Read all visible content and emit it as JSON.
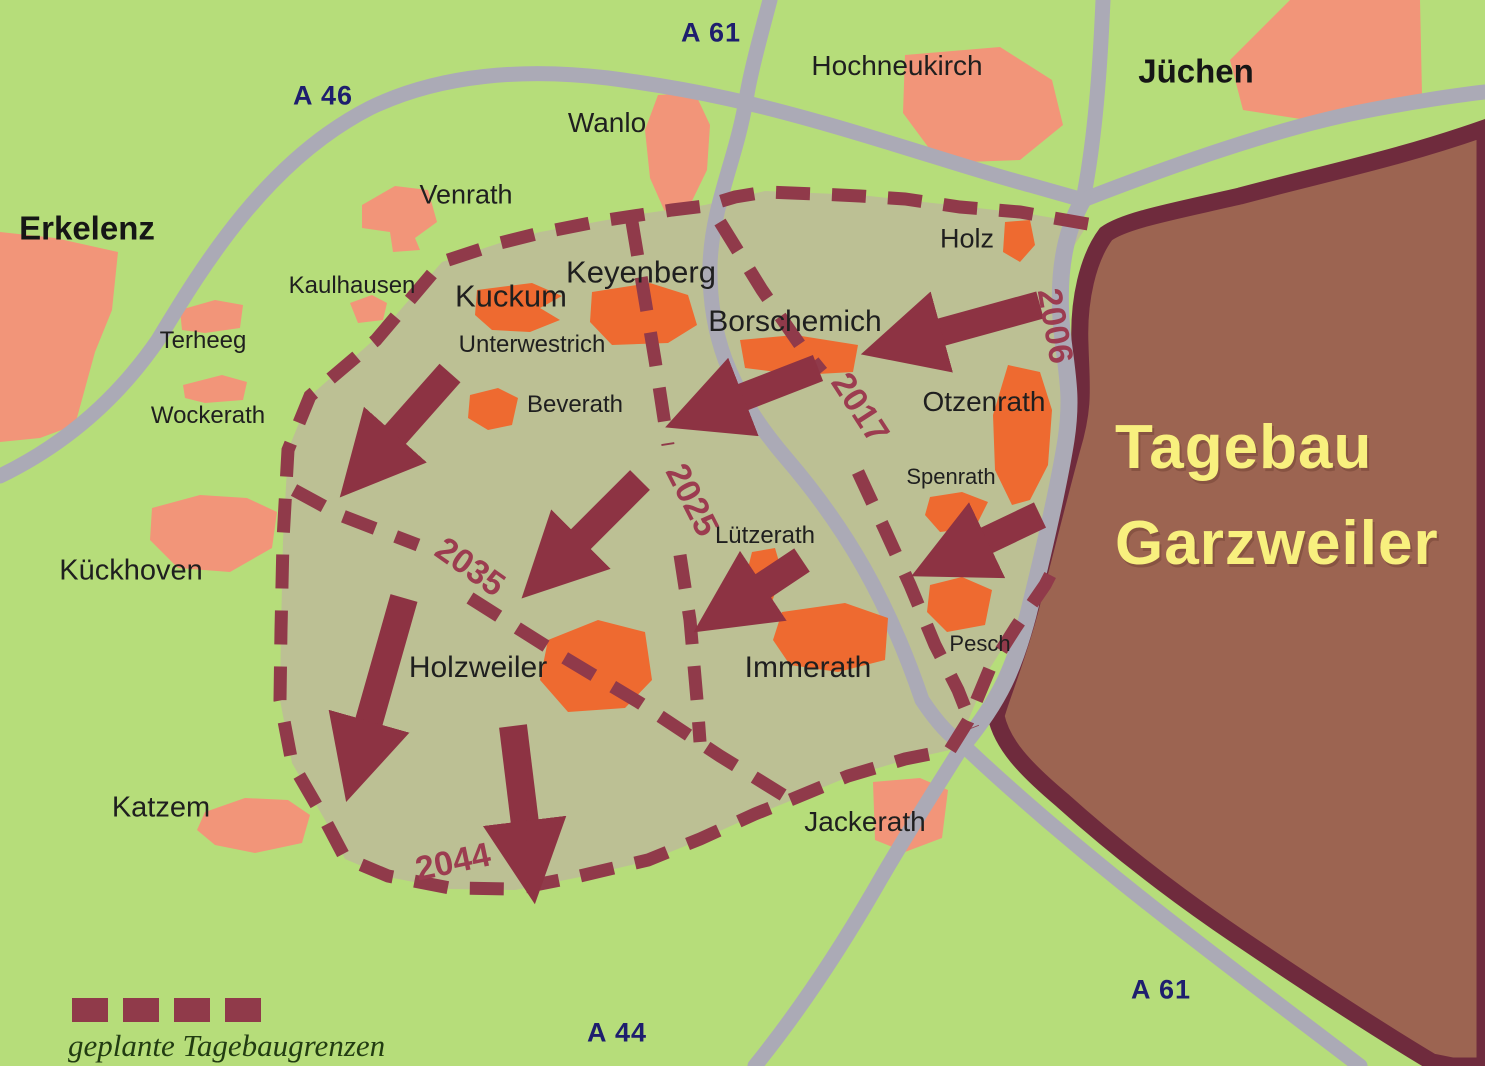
{
  "map": {
    "title": {
      "line1": "Tagebau",
      "line2": "Garzweiler"
    },
    "legend": {
      "label": "geplante Tagebaugrenzen"
    },
    "highways": [
      {
        "id": "a46",
        "label": "A 46"
      },
      {
        "id": "a61_top",
        "label": "A 61"
      },
      {
        "id": "a61_bottom",
        "label": "A 61"
      },
      {
        "id": "a44",
        "label": "A 44"
      }
    ],
    "expansion_years": [
      {
        "id": "y2006",
        "label": "2006"
      },
      {
        "id": "y2017",
        "label": "2017"
      },
      {
        "id": "y2025",
        "label": "2025"
      },
      {
        "id": "y2035",
        "label": "2035"
      },
      {
        "id": "y2044",
        "label": "2044"
      }
    ],
    "villages_outside_area": [
      "Erkelenz",
      "Terheeg",
      "Wockerath",
      "Kückhoven",
      "Katzem",
      "Venrath",
      "Kaulhausen",
      "Wanlo",
      "Hochneukirch",
      "Jüchen",
      "Jackerath"
    ],
    "villages_inside_area": [
      "Keyenberg",
      "Kuckum",
      "Unterwestrich",
      "Beverath",
      "Borschemich",
      "Holz",
      "Otzenrath",
      "Spenrath",
      "Lützerath",
      "Pesch",
      "Holzweiler",
      "Immerath"
    ],
    "colors": {
      "background": "#b6dd7a",
      "planned_area": "#bcc094",
      "mine_fill": "#9c6451",
      "mine_border": "#6f2b3d",
      "village_outside": "#f29579",
      "village_inside": "#ee6a30",
      "road": "#abaab6",
      "boundary_dash": "#903a4a",
      "arrow": "#8d3343",
      "year_text": "#9c3c50",
      "highway_text": "#1e1e6e",
      "title_text": "#f8f07e",
      "legend_text": "#223c12"
    }
  },
  "labels": {
    "erkelenz": "Erkelenz",
    "terheeg": "Terheeg",
    "wockerath": "Wockerath",
    "kueckhoven": "Kückhoven",
    "katzem": "Katzem",
    "venrath": "Venrath",
    "kaulhausen": "Kaulhausen",
    "wanlo": "Wanlo",
    "hochneukirch": "Hochneukirch",
    "juechen": "Jüchen",
    "keyenberg": "Keyenberg",
    "kuckum": "Kuckum",
    "unterwestrich": "Unterwestrich",
    "beverath": "Beverath",
    "borschemich": "Borschemich",
    "holz": "Holz",
    "otzenrath": "Otzenrath",
    "spenrath": "Spenrath",
    "luetzerath": "Lützerath",
    "pesch": "Pesch",
    "holzweiler": "Holzweiler",
    "immerath": "Immerath",
    "jackerath": "Jackerath",
    "a46": "A 46",
    "a61_top": "A 61",
    "a44": "A 44",
    "a61_bottom": "A 61",
    "y2006": "2006",
    "y2017": "2017",
    "y2025": "2025",
    "y2035": "2035",
    "y2044": "2044",
    "title_line1": "Tagebau",
    "title_line2": "Garzweiler",
    "legend": "geplante Tagebaugrenzen"
  }
}
